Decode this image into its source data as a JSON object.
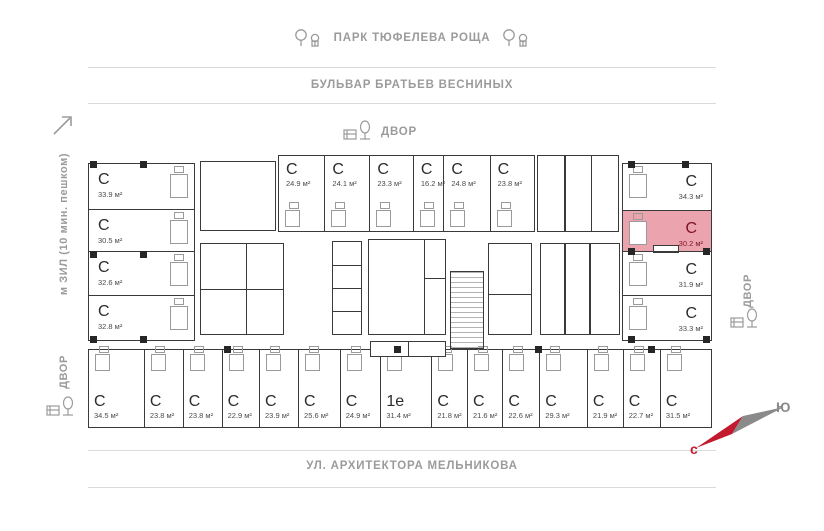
{
  "labels": {
    "park": "ПАРК ТЮФЕЛЕВА РОЩА",
    "boulevard": "БУЛЬВАР БРАТЬЕВ ВЕСНИНЫХ",
    "yard_top": "ДВОР",
    "yard_left": "ДВОР",
    "yard_right": "ДВОР",
    "metro": "м ЗИЛ (10 мин. пешком)",
    "street_bottom": "УЛ. АРХИТЕКТОРА МЕЛЬНИКОВА",
    "compass_north": "с",
    "compass_south": "Ю"
  },
  "icons": {
    "park_side": "trees-icon",
    "yard": "courtyard-bench-tree-icon",
    "metro_direction": "arrow-up-right-icon",
    "compass": "compass-needle-icon"
  },
  "colors": {
    "label_gray": "#9b9b9b",
    "line_gray": "#dbdbdb",
    "wall_dark": "#3a3a3a",
    "unit_type_text": "#2d2d2d",
    "unit_area_text": "#4a4a4a",
    "highlight_fill": "#eba3ae",
    "highlight_text": "#7c1322",
    "compass_red": "#c21b2f",
    "compass_gray": "#8a8a8a"
  },
  "units": {
    "left_column": [
      {
        "type": "С",
        "area": "33.9 м²"
      },
      {
        "type": "С",
        "area": "30.5 м²"
      },
      {
        "type": "С",
        "area": "32.6 м²"
      },
      {
        "type": "С",
        "area": "32.8 м²"
      }
    ],
    "top_row": [
      {
        "type": "С",
        "area": "24.9 м²"
      },
      {
        "type": "С",
        "area": "24.1 м²"
      },
      {
        "type": "С",
        "area": "23.3 м²"
      },
      {
        "type": "С",
        "area": "16.2 м²"
      },
      {
        "type": "С",
        "area": "24.8 м²"
      },
      {
        "type": "С",
        "area": "23.8 м²"
      }
    ],
    "right_column": [
      {
        "type": "С",
        "area": "34.3 м²"
      },
      {
        "type": "С",
        "area": "30.2 м²",
        "highlighted": true
      },
      {
        "type": "С",
        "area": "31.9 м²"
      },
      {
        "type": "С",
        "area": "33.3 м²"
      }
    ],
    "bottom_row": [
      {
        "type": "С",
        "area": "34.5 м²"
      },
      {
        "type": "С",
        "area": "23.8 м²"
      },
      {
        "type": "С",
        "area": "23.8 м²"
      },
      {
        "type": "С",
        "area": "22.9 м²"
      },
      {
        "type": "С",
        "area": "23.9 м²"
      },
      {
        "type": "С",
        "area": "25.6 м²"
      },
      {
        "type": "С",
        "area": "24.9 м²"
      },
      {
        "type": "1е",
        "area": "31.4 м²"
      },
      {
        "type": "С",
        "area": "21.8 м²"
      },
      {
        "type": "С",
        "area": "21.6 м²"
      },
      {
        "type": "С",
        "area": "22.6 м²"
      },
      {
        "type": "С",
        "area": "29.3 м²"
      },
      {
        "type": "С",
        "area": "21.9 м²"
      },
      {
        "type": "С",
        "area": "22.7 м²"
      },
      {
        "type": "С",
        "area": "31.5 м²"
      }
    ]
  }
}
